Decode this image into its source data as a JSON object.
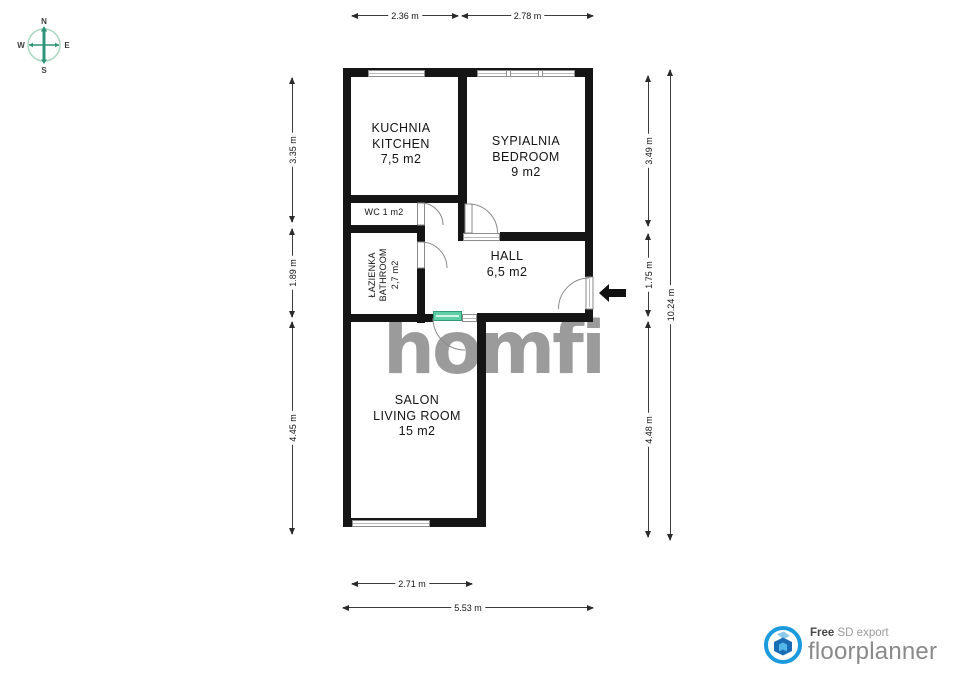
{
  "compass": {
    "n": "N",
    "e": "E",
    "s": "S",
    "w": "W"
  },
  "rooms": {
    "kitchen": {
      "l1": "KUCHNIA",
      "l2": "KITCHEN",
      "area": "7,5 m2"
    },
    "bedroom": {
      "l1": "SYPIALNIA",
      "l2": "BEDROOM",
      "area": "9 m2"
    },
    "wc": {
      "l1": "WC 1 m2"
    },
    "bathroom": {
      "l1": "ŁAZIENKA",
      "l2": "BATHROOM",
      "area": "2,7 m2"
    },
    "hall": {
      "l1": "HALL",
      "area": "6,5 m2"
    },
    "living": {
      "l1": "SALON",
      "l2": "LIVING ROOM",
      "area": "15 m2"
    }
  },
  "dimensions": {
    "top_left": "2.36 m",
    "top_right": "2.78 m",
    "left_1": "3.35 m",
    "left_2": "1.89 m",
    "left_3": "4.45 m",
    "right_1": "3.49 m",
    "right_2": "1.75 m",
    "right_3": "4.48 m",
    "right_total": "10.24 m",
    "bottom_inner": "2.71 m",
    "bottom_outer": "5.53 m"
  },
  "watermark": "homfi",
  "branding": {
    "free": "Free",
    "export_type": "SD export",
    "name": "floorplanner"
  },
  "colors": {
    "wall": "#151515",
    "accent_green": "#5ecfa6",
    "compass_green": "#2e9678",
    "brand_blue": "#1b9bde",
    "watermark_gray": "#9b9b9b"
  }
}
